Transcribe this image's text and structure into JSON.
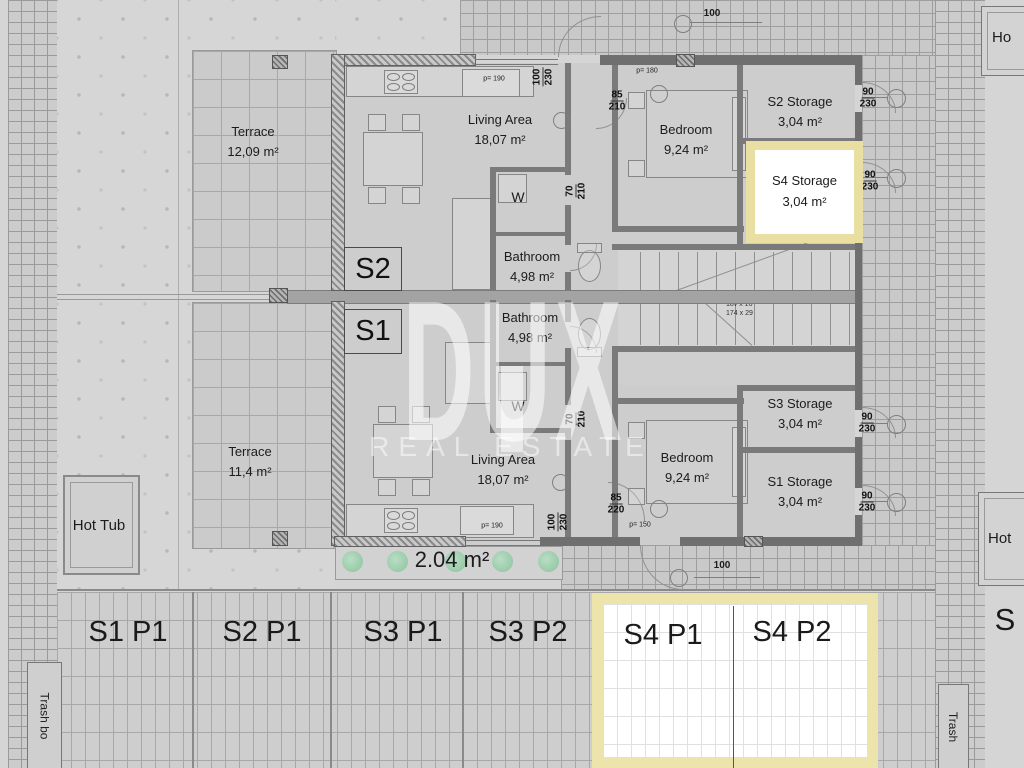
{
  "watermark": {
    "brand": "DUX",
    "tagline": "REAL ESTATE"
  },
  "units": {
    "s2": "S2",
    "s1": "S1"
  },
  "rooms": {
    "terrace_upper": {
      "name": "Terrace",
      "area": "12,09 m²"
    },
    "living_upper": {
      "name": "Living Area",
      "area": "18,07 m²"
    },
    "bedroom_upper": {
      "name": "Bedroom",
      "area": "9,24 m²"
    },
    "bathroom_upper": {
      "name": "Bathroom",
      "area": "4,98 m²"
    },
    "washer_upper": {
      "name": "W"
    },
    "storage_s2": {
      "name": "S2 Storage",
      "area": "3,04 m²"
    },
    "storage_s4": {
      "name": "S4 Storage",
      "area": "3,04 m²"
    },
    "terrace_lower": {
      "name": "Terrace",
      "area": "11,4 m²"
    },
    "living_lower": {
      "name": "Living Area",
      "area": "18,07 m²"
    },
    "bedroom_lower": {
      "name": "Bedroom",
      "area": "9,24 m²"
    },
    "bathroom_lower": {
      "name": "Bathroom",
      "area": "4,98 m²"
    },
    "washer_lower": {
      "name": "W"
    },
    "storage_s3": {
      "name": "S3 Storage",
      "area": "3,04 m²"
    },
    "storage_s1": {
      "name": "S1 Storage",
      "area": "3,04 m²"
    },
    "hot_tub": {
      "name": "Hot Tub"
    },
    "garden": {
      "area": "2.04 m²"
    }
  },
  "parking": {
    "s1p1": "S1 P1",
    "s2p1": "S2 P1",
    "s3p1": "S3 P1",
    "s3p2": "S3 P2",
    "s4p1": "S4 P1",
    "s4p2": "S4 P2",
    "neighbor": "S"
  },
  "edge_labels": {
    "hot_tub_right_top": "Ho",
    "hot_tub_right_mid": "Hot",
    "trash_left": "Trash bo",
    "trash_right": "Trash"
  },
  "dimensions": {
    "entry_upper": "100",
    "entry_lower": "100",
    "door_entry_upper": {
      "w": "100",
      "h": "230"
    },
    "door_entry_lower": {
      "w": "100",
      "h": "230"
    },
    "door_bedroom_upper": {
      "w": "85",
      "h": "210"
    },
    "door_bedroom_lower": {
      "w": "85",
      "h": "220"
    },
    "door_bathroom_upper": {
      "w": "70",
      "h": "210"
    },
    "door_bathroom_lower": {
      "w": "70",
      "h": "210"
    },
    "door_storage_s2": {
      "w": "90",
      "h": "230"
    },
    "door_storage_s4": {
      "w": "90",
      "h": "230"
    },
    "door_storage_s3": {
      "w": "90",
      "h": "230"
    },
    "door_storage_s1": {
      "w": "90",
      "h": "230"
    },
    "parapet_bedroom_upper": "p= 180",
    "parapet_kitchen_upper": "p= 190",
    "parapet_kitchen_lower": "p= 190",
    "parapet_bedroom_lower": "p= 150"
  },
  "stairs": {
    "note_line1": "18v x 16",
    "note_line2": "174 x 29"
  },
  "colors": {
    "background": "#d5d5d5",
    "wall": "#6f6f6f",
    "highlight_border": "#eadfa2",
    "highlight_fill": "#ffffff",
    "bush_green": "#8fcfa5",
    "text": "#1c1c1c"
  }
}
